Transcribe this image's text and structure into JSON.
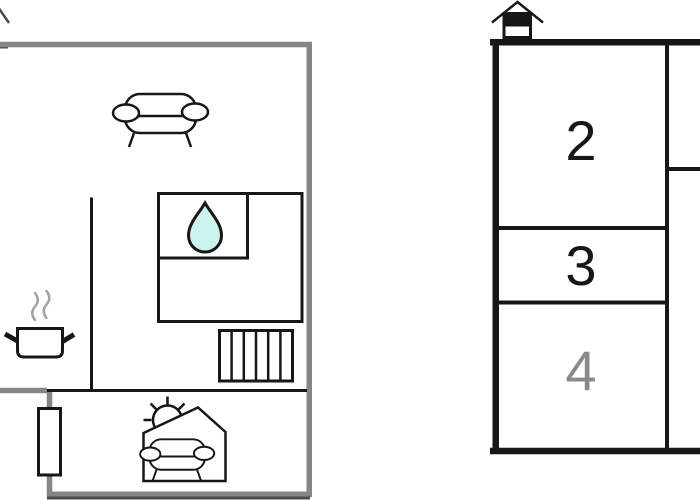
{
  "colors": {
    "background": "#ffffff",
    "wall_gray": "#868686",
    "line_black": "#171717",
    "drop_fill": "#cdf3ef",
    "steam_gray": "#a3a3a3",
    "dark_edge": "#4a4a4a"
  },
  "ground_floor": {
    "icons": [
      "cutoff-house-roof-icon",
      "sofa-icon",
      "water-drop-icon",
      "cooking-pot-icon",
      "steam-icon",
      "stairs-icon",
      "window-icon",
      "sun-icon",
      "conservatory-sofa-icon"
    ]
  },
  "upper_floor": {
    "icons": [
      "house-level-icon"
    ],
    "rooms": [
      {
        "id": "room-2",
        "label": "2",
        "label_color": "#171717"
      },
      {
        "id": "room-3",
        "label": "3",
        "label_color": "#171717"
      },
      {
        "id": "room-4",
        "label": "4",
        "label_color": "#8a8a8a"
      }
    ]
  }
}
